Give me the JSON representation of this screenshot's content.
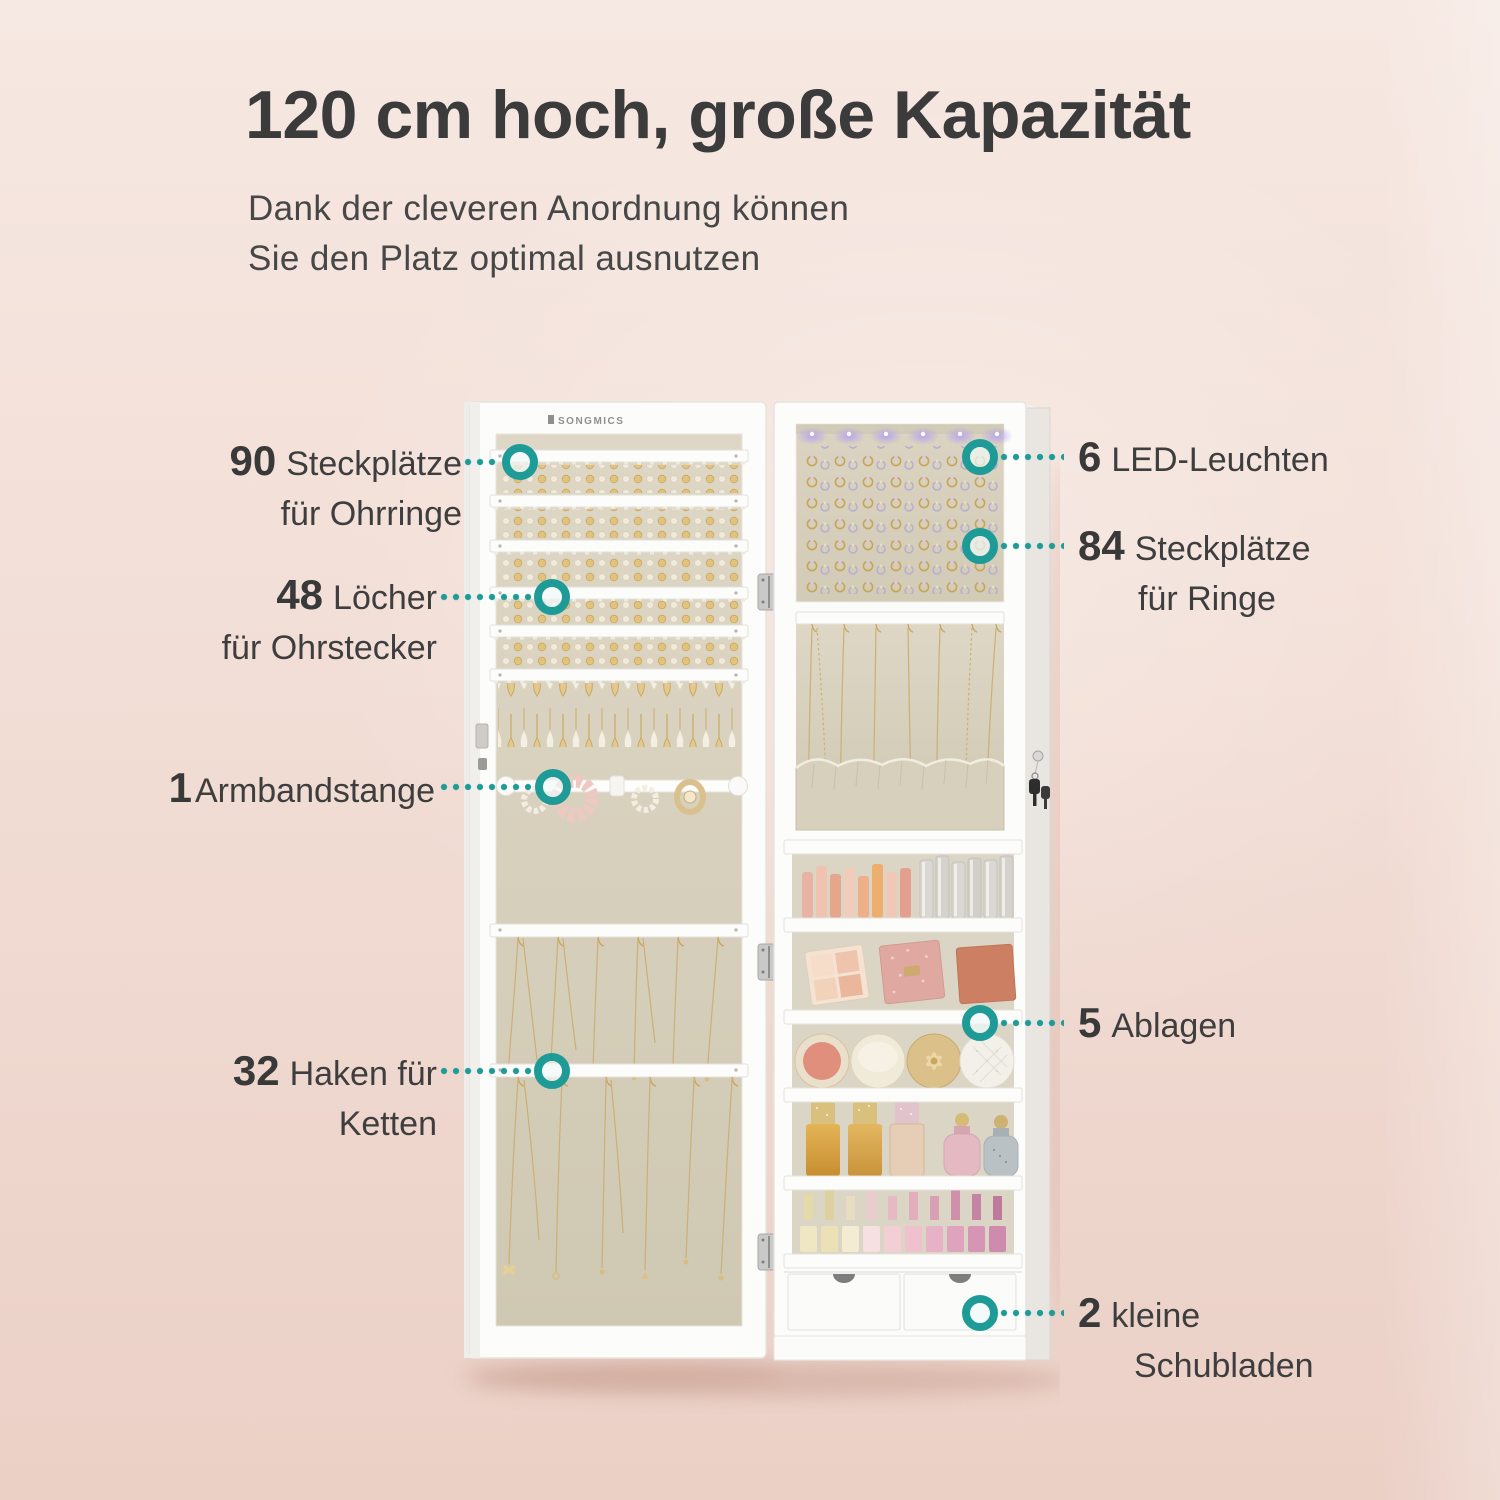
{
  "brand": "SONGMICS",
  "header": {
    "title": "120 cm hoch, große Kapazität",
    "subtitle_line1": "Dank der cleveren Anordnung können",
    "subtitle_line2": "Sie den Platz optimal ausnutzen"
  },
  "colors": {
    "accent_teal": "#1e9b97",
    "background_top": "#f6e8e2",
    "background_bottom": "#ebd0c6",
    "text_dark": "#3b3b3b",
    "cabinet_white": "#fcfcfb",
    "fabric_beige": "#d8d1bf",
    "led_glow": "#b3a0f0"
  },
  "callouts": {
    "left": [
      {
        "number": "90",
        "line1": "Steckplätze",
        "line2": "für Ohrringe"
      },
      {
        "number": "48",
        "line1": "Löcher",
        "line2": "für Ohrstecker"
      },
      {
        "number": "1",
        "line1": "Armbandstange",
        "line2": ""
      },
      {
        "number": "32",
        "line1": "Haken für",
        "line2": "Ketten"
      }
    ],
    "right": [
      {
        "number": "6",
        "line1": "LED-Leuchten",
        "line2": ""
      },
      {
        "number": "84",
        "line1": "Steckplätze",
        "line2": "für Ringe"
      },
      {
        "number": "5",
        "line1": "Ablagen",
        "line2": ""
      },
      {
        "number": "2",
        "line1": "kleine",
        "line2": "Schubladen"
      }
    ]
  }
}
